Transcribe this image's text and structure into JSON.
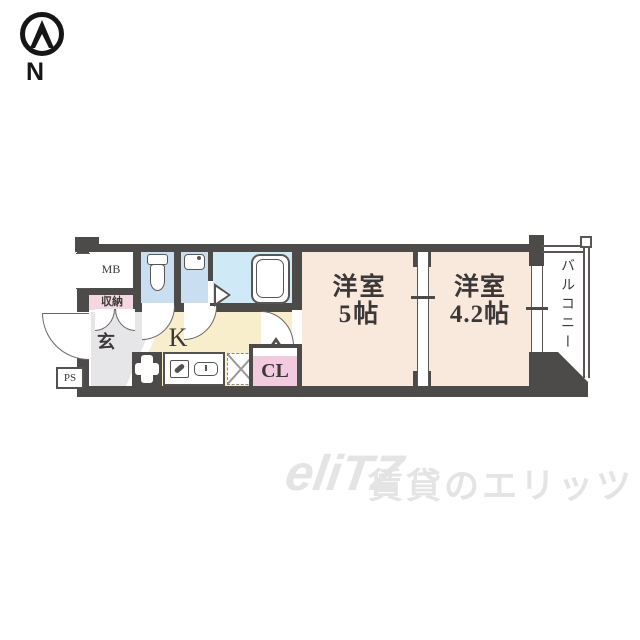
{
  "compass": {
    "north_label": "N"
  },
  "floorplan": {
    "rooms": {
      "meter_box": {
        "label": "MB"
      },
      "storage": {
        "label": "収納"
      },
      "entrance": {
        "label": "玄"
      },
      "kitchen": {
        "label": "K"
      },
      "closet": {
        "label": "CL"
      },
      "western_room_5": {
        "name": "洋室",
        "size": "5帖"
      },
      "western_room_4_2": {
        "name": "洋室",
        "size": "4.2帖"
      },
      "balcony": {
        "label": "バルコニー"
      },
      "pipe_space": {
        "label": "PS"
      }
    },
    "icons": {
      "compass": "north-arrow-icon",
      "fixtures": [
        "toilet-icon",
        "washbasin-icon",
        "bathtub-icon",
        "stove-icon",
        "kitchen-sink-icon",
        "refrigerator-space-icon"
      ],
      "openings": [
        "entrance-door-arc",
        "toilet-door-arc",
        "washbasin-door-arc",
        "room-door-arc",
        "closet-double-door-arcs",
        "bath-folding-door",
        "sliding-partition",
        "window-to-balcony"
      ]
    }
  },
  "watermark": {
    "logo": "eliTZ",
    "tagline": "賃貸のエリッツ"
  },
  "colors": {
    "wall": "#4d4a4a",
    "room": "#f9e8dc",
    "kitchen": "#f8eecb",
    "water": "#c9dff1",
    "bath": "#cfeaf6",
    "storage": "#f3d8e3",
    "closet": "#f2cbdf",
    "genkan": "#e6e5e7",
    "text": "#3c3838",
    "watermark": "#e4e4e4"
  }
}
